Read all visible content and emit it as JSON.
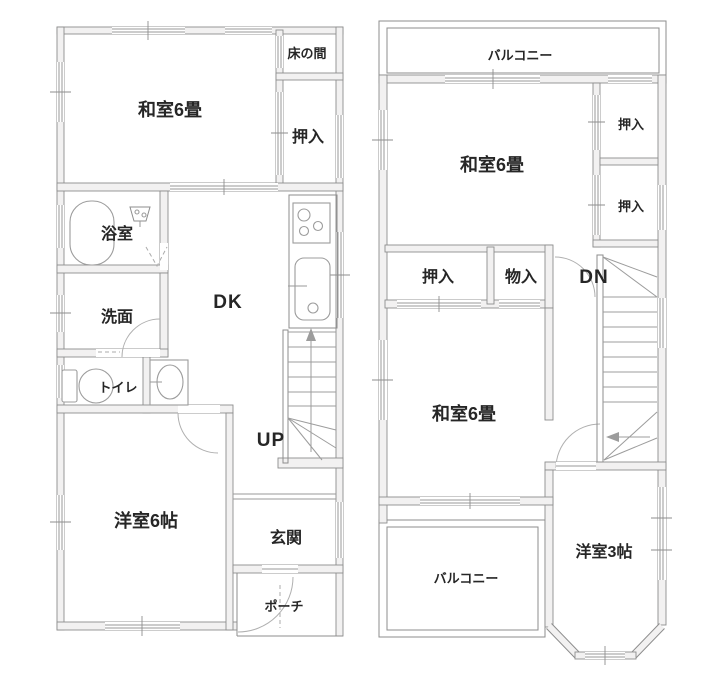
{
  "title": "2-story house floor plan",
  "colors": {
    "background": "#ffffff",
    "wall_fill": "#f2f1f1",
    "wall_line": "#8d8d8d",
    "text": "#262626"
  },
  "floor1": {
    "rooms": {
      "washitsu": "和室6畳",
      "tokonoma": "床の間",
      "oshiire": "押入",
      "bathroom": "浴室",
      "washroom": "洗面",
      "toilet": "トイレ",
      "dining_kitchen": "DK",
      "stairs": "UP",
      "western_room": "洋室6帖",
      "entrance": "玄関",
      "porch": "ポーチ"
    }
  },
  "floor2": {
    "rooms": {
      "balcony_north": "バルコニー",
      "washitsu_north": "和室6畳",
      "oshiire_right_upper": "押入",
      "oshiire_right_lower": "押入",
      "oshiire_center": "押入",
      "storage": "物入",
      "stairs": "DN",
      "washitsu_south": "和室6畳",
      "balcony_south": "バルコニー",
      "western_room": "洋室3帖"
    }
  }
}
